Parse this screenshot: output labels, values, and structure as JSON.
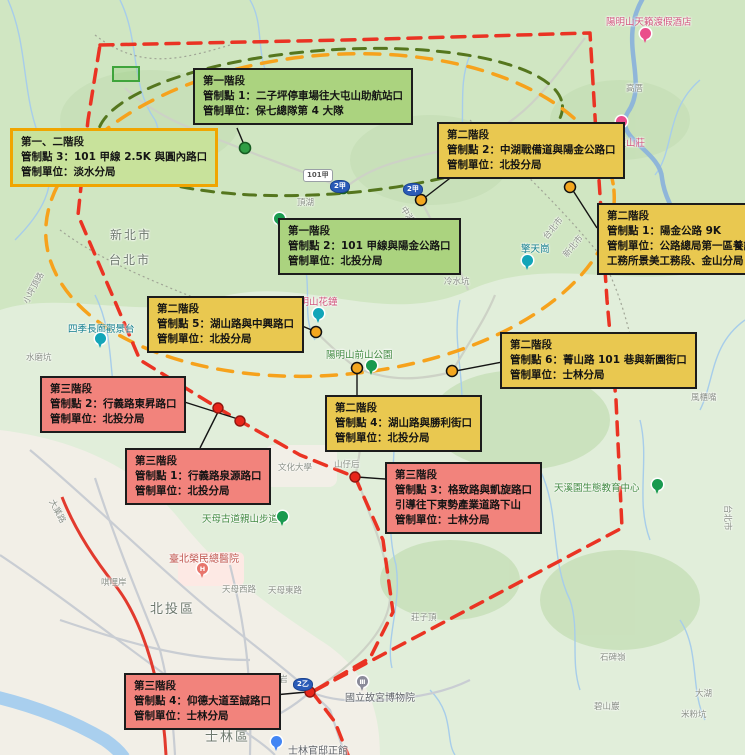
{
  "phases": {
    "phase1_color": "#abd37f",
    "phase2_color": "#e9c850",
    "phase3_color": "#f2837c",
    "phase1and2_border": "#f0a500",
    "boundary_red": "#ea3323",
    "boundary_orange": "#f6a21c",
    "boundary_green": "#55761e"
  },
  "callouts": [
    {
      "id": "phase1-point1",
      "variant": "green",
      "x": 193,
      "y": 68,
      "lines": [
        "第一階段",
        "管制點 1：二子坪停車場往大屯山助航站口",
        "管制單位：保七總隊第 4 大隊"
      ]
    },
    {
      "id": "phase1and2-point3",
      "variant": "green-yellow",
      "x": 10,
      "y": 128,
      "lines": [
        "第一、二階段",
        "管制點 3：101 甲線 2.5K 與圓內路口",
        "管制單位：淡水分局"
      ]
    },
    {
      "id": "phase2-point2",
      "variant": "yellow",
      "x": 437,
      "y": 122,
      "lines": [
        "第二階段",
        "管制點 2：中湖戰備道與陽金公路口",
        "管制單位：北投分局"
      ]
    },
    {
      "id": "phase2-point1",
      "variant": "yellow",
      "x": 597,
      "y": 203,
      "lines": [
        "第二階段",
        "管制點 1：陽金公路 9K",
        "管制單位：公路總局第一區養護",
        "工務所景美工務段、金山分局"
      ]
    },
    {
      "id": "phase1-point2",
      "variant": "green",
      "x": 278,
      "y": 218,
      "lines": [
        "第一階段",
        "管制點 2：101 甲線與陽金公路口",
        "管制單位：北投分局"
      ]
    },
    {
      "id": "phase2-point5",
      "variant": "yellow",
      "x": 147,
      "y": 296,
      "lines": [
        "第二階段",
        "管制點 5：湖山路與中興路口",
        "管制單位：北投分局"
      ]
    },
    {
      "id": "phase2-point6",
      "variant": "yellow",
      "x": 500,
      "y": 332,
      "lines": [
        "第二階段",
        "管制點 6：菁山路 101 巷與新園街口",
        "管制單位：士林分局"
      ]
    },
    {
      "id": "phase3-point2",
      "variant": "red",
      "x": 40,
      "y": 376,
      "lines": [
        "第三階段",
        "管制點 2：行義路東昇路口",
        "管制單位：北投分局"
      ]
    },
    {
      "id": "phase2-point4",
      "variant": "yellow",
      "x": 325,
      "y": 395,
      "lines": [
        "第二階段",
        "管制點 4：湖山路與勝利街口",
        "管制單位：北投分局"
      ]
    },
    {
      "id": "phase3-point1",
      "variant": "red",
      "x": 125,
      "y": 448,
      "lines": [
        "第三階段",
        "管制點 1：行義路泉源路口",
        "管制單位：北投分局"
      ]
    },
    {
      "id": "phase3-point3",
      "variant": "red",
      "x": 385,
      "y": 462,
      "lines": [
        "第三階段",
        "管制點 3：格致路與凱旋路口",
        "引導往下東勢產業道路下山",
        "管制單位：士林分局"
      ]
    },
    {
      "id": "phase3-point4",
      "variant": "red",
      "x": 124,
      "y": 673,
      "lines": [
        "第三階段",
        "管制點 4：仰德大道至誠路口",
        "管制單位：士林分局"
      ]
    }
  ],
  "map": {
    "labels": {
      "tianlai": "陽明山天籟渡假酒店",
      "gaocuo": "高厝",
      "resort2": "渡假山莊",
      "dinghu": "頂湖",
      "xinbei_left": "新北市",
      "taipei_left": "台北市",
      "taipei_border": "台北市",
      "xinbei_border": "新北市",
      "qingtiangang": "擎天崗",
      "lengshuikeng": "冷水坑",
      "zhonghu_rd": "中湖戰備道",
      "huazhong": "陽明山花鐘",
      "qianshan": "陽明山前山公園",
      "siji": "四季長廊觀景台",
      "shuimokeng": "水磨坑",
      "xiaopingding": "小坪頂路",
      "shanzihou": "山仔后",
      "wenhua": "文化大學",
      "tianmu_trail": "天母古道親山步道",
      "rongzong": "臺北榮民總醫院",
      "qilian": "唭哩岸",
      "tianmu_w": "天母西路",
      "tianmu_e": "天母東路",
      "beitou": "北投區",
      "dayelu": "大業路",
      "shilin": "士林區",
      "gugong": "國立故宮博物院",
      "guandi": "士林官邸正館",
      "zhishanyan": "芝山岩",
      "tianxiyuan": "天溪園生態教育中心",
      "zhuangziding": "莊子頂",
      "shibeiling": "石碑嶺",
      "bishanyan": "碧山巖",
      "mifenkeng": "米粉坑",
      "fengguizui": "風櫃嘴",
      "dahu": "大湖",
      "taipei_right": "台北市"
    },
    "shields": {
      "s101": "101甲",
      "s2a": "2甲",
      "s2b": "2甲",
      "s2c": "2乙"
    },
    "pin_glyphs": {
      "hospital": "H",
      "museum": "Ⅲ"
    },
    "control_points": [
      {
        "phase": 1,
        "color": "green",
        "x": 245,
        "y": 148
      },
      {
        "phase": 1,
        "color": "green",
        "x": 343,
        "y": 188
      },
      {
        "phase": 2,
        "color": "yellow",
        "x": 421,
        "y": 200
      },
      {
        "phase": 2,
        "color": "yellow",
        "x": 570,
        "y": 187
      },
      {
        "phase": 2,
        "color": "yellow",
        "x": 316,
        "y": 332
      },
      {
        "phase": 2,
        "color": "yellow",
        "x": 357,
        "y": 368
      },
      {
        "phase": 2,
        "color": "yellow",
        "x": 452,
        "y": 371
      },
      {
        "phase": 3,
        "color": "red",
        "x": 218,
        "y": 408
      },
      {
        "phase": 3,
        "color": "red",
        "x": 240,
        "y": 421
      },
      {
        "phase": 3,
        "color": "red",
        "x": 355,
        "y": 477
      },
      {
        "phase": 3,
        "color": "red",
        "x": 310,
        "y": 692
      }
    ]
  }
}
